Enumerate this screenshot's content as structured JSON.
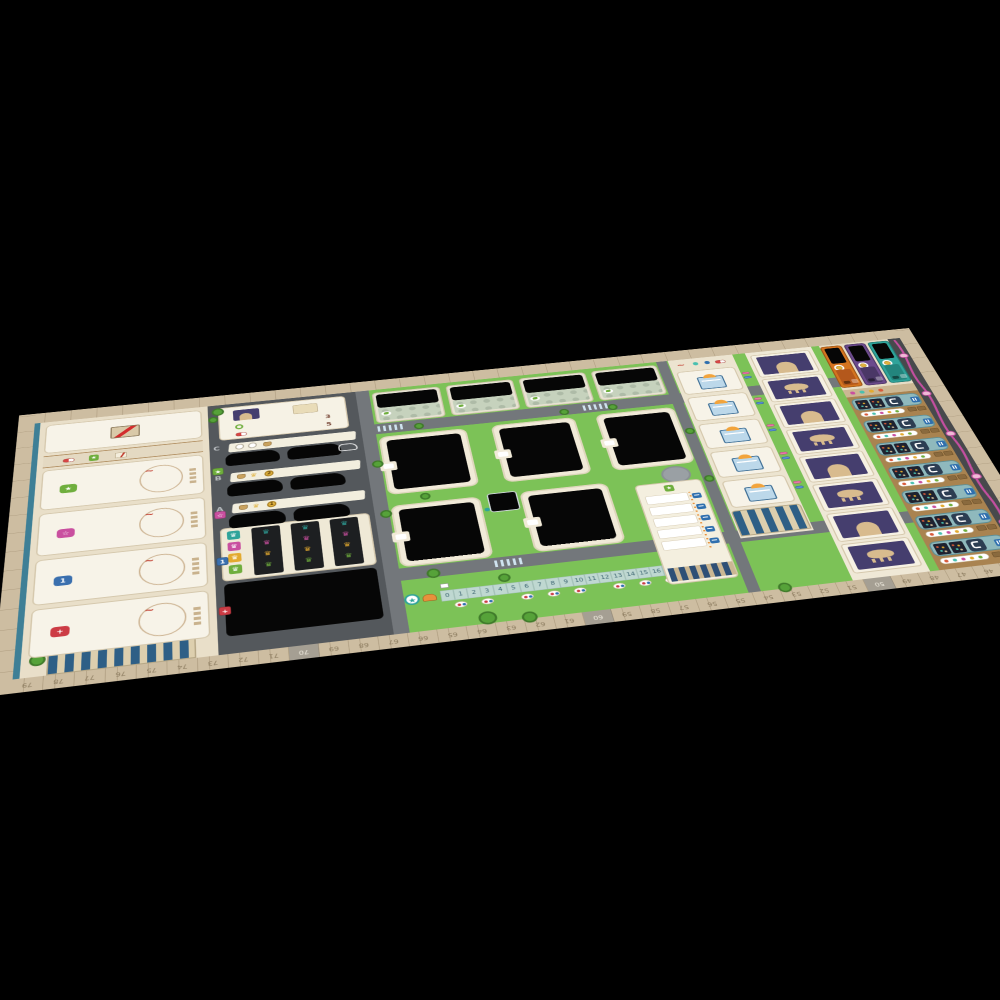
{
  "scene": {
    "background": "#000000",
    "subject": "hospital-city board game mat, perspective photo on black"
  },
  "colors": {
    "board_border": "#cdbda1",
    "board_face": "#e7ddc6",
    "parking_asphalt": "#54585c",
    "grass": "#7cc257",
    "road": "#73777b",
    "cutout_black": "#060606",
    "accent_teal": "#2fa39a",
    "accent_magenta": "#c94f9f",
    "accent_yellow": "#e3aa2f",
    "accent_green": "#6fae3d",
    "deck_orange": "#d4741f",
    "deck_purple": "#6b4a8c",
    "deck_teal": "#2fa39a",
    "staff_panel_brown": "#a98350",
    "shelf_teal": "#8fb9bd",
    "bed_pillow_orange": "#f2a43c",
    "patient_art_purple": "#453e6e",
    "reputation_pink": "#c44fa0",
    "track_cell_teal": "#bfd8d1",
    "tag_blue": "#2f6fae"
  },
  "left_panel": {
    "no_card": {
      "icon": "no-entry-sign"
    },
    "divider_icons": [
      "red-capsule",
      "green-star-badge",
      "prescription-note"
    ],
    "action_cards": [
      {
        "badge_icon": "plus-star",
        "badge_color": "#6fae3d",
        "value": ""
      },
      {
        "badge_icon": "plus-star-outline",
        "badge_color": "#c94f9f",
        "value": ""
      },
      {
        "badge_icon": "plus-block",
        "badge_color": "#3a6fae",
        "value": "1"
      },
      {
        "badge_icon": "plus-cross-chip",
        "badge_color": "#cc3b44",
        "value": ""
      }
    ]
  },
  "parking": {
    "legend": {
      "rows": [
        {
          "icons": "wreath-star",
          "value": "3"
        },
        {
          "icons": "capsules",
          "value": "5"
        }
      ]
    },
    "rows": [
      {
        "label": "C",
        "cost": "",
        "car_slots": 2,
        "ghost_car": true
      },
      {
        "label": "B",
        "cost": "2",
        "car_slots": 2,
        "ghost_car": false
      },
      {
        "label": "A",
        "cost": "1",
        "car_slots": 2,
        "ghost_car": false
      }
    ],
    "crown_colors": [
      "#2fa39a",
      "#c94f9f",
      "#e3aa2f",
      "#6fae3d"
    ],
    "crown_columns": 3
  },
  "campus": {
    "department_buildings": 4,
    "ward_buildings": 5,
    "helipad": true,
    "inner_track": {
      "start_icon": "star-circle",
      "numbers": [
        "0",
        "1",
        "2",
        "3",
        "4",
        "5",
        "6",
        "7",
        "8",
        "9",
        "10",
        "11",
        "12",
        "13",
        "14",
        "15",
        "16",
        "17",
        "18"
      ]
    },
    "waiting_panel": {
      "rows": 5
    }
  },
  "bed_column": {
    "beds": 5
  },
  "patient_queue": {
    "frames": [
      "head",
      "animal",
      "head",
      "animal",
      "head",
      "animal",
      "head",
      "animal"
    ]
  },
  "decks": [
    {
      "name": "orange-deck",
      "color": "#d4741f",
      "badge": "coin"
    },
    {
      "name": "purple-deck",
      "color": "#6b4a8c",
      "badge": "coin"
    },
    {
      "name": "teal-deck",
      "color": "#2fa39a",
      "badge": "coin"
    }
  ],
  "staff_panel": {
    "rows": 7
  },
  "reputation_path": {
    "nodes": 5
  },
  "perimeter_track": {
    "bottom_numbers": [
      "79",
      "78",
      "77",
      "76",
      "75",
      "74",
      "73",
      "72",
      "71",
      "70",
      "69",
      "68",
      "67",
      "66",
      "65",
      "64",
      "63",
      "62",
      "61",
      "60",
      "59",
      "58",
      "57",
      "56",
      "55",
      "54",
      "53",
      "52",
      "51",
      "50",
      "49",
      "48",
      "47",
      "46",
      "45"
    ]
  }
}
